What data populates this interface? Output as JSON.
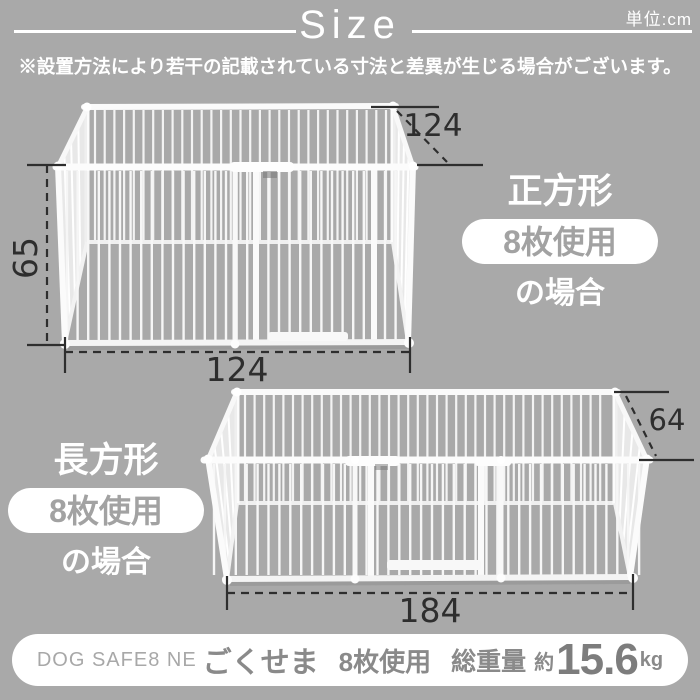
{
  "header": {
    "title": "Size",
    "unit": "単位:cm",
    "disclaimer": "※設置方法により若干の記載されている寸法と差異が生じる場合がございます。"
  },
  "square_config": {
    "shape": "正方形",
    "badge": "8枚使用",
    "case": "の場合",
    "width": "124",
    "depth": "124",
    "height": "65"
  },
  "rect_config": {
    "shape": "長方形",
    "badge": "8枚使用",
    "case": "の場合",
    "width": "184",
    "depth": "64"
  },
  "footer": {
    "code": "DOG SAFE8 NE",
    "name": "ごくせま",
    "usage": "8枚使用",
    "weight_label": "総重量",
    "approx": "約",
    "weight_value": "15.6",
    "weight_unit": "kg"
  },
  "colors": {
    "background": "#a9a9a9",
    "text_on_gray": "#ffffff",
    "dimension": "#2e2e2e",
    "badge_text": "#a2a2a2",
    "footer_text": "#8a8a8a"
  }
}
